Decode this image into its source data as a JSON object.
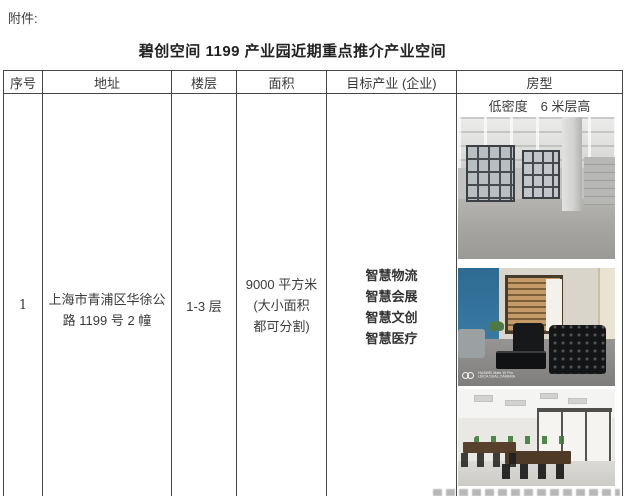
{
  "page": {
    "attachment_label": "附件:",
    "title": "碧创空间 1199 产业园近期重点推介产业空间",
    "text_color": "#3b3b3b",
    "border_color": "#474747"
  },
  "table": {
    "headers": {
      "seq": "序号",
      "address": "地址",
      "floor": "楼层",
      "area": "面积",
      "industry": "目标产业 (企业)",
      "room": "房型"
    },
    "row1": {
      "seq": "1",
      "address_line1": "上海市青浦区华徐公",
      "address_line2": "路 1199 号 2 幢",
      "floor": "1-3 层",
      "area_line1": "9000 平方米",
      "area_line2": "(大小面积",
      "area_line3": "都可分割)",
      "industry_line1": "智慧物流",
      "industry_line2": "智慧会展",
      "industry_line3": "智慧文创",
      "industry_line4": "智慧医疗",
      "room_note": "低密度　6 米层高",
      "watermark_line1": "HUAWEI Mate 10 Pro",
      "watermark_line2": "LEICA DUAL CAMERA"
    }
  }
}
